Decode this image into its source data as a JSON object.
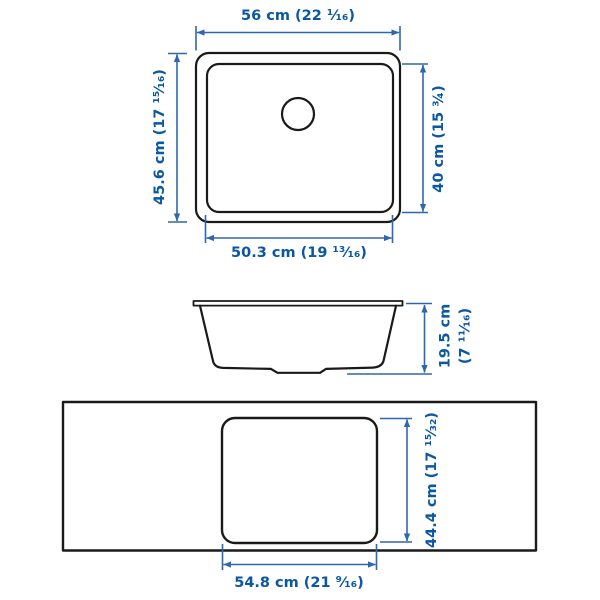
{
  "diagram": {
    "subject": "sink-dimension-drawing",
    "colors": {
      "dimension_blue": "#0a57a4",
      "dimension_line_blue": "#2e67ad",
      "drawing_black": "#1a1a1a",
      "background": "#ffffff"
    },
    "top_view": {
      "width_label": "56 cm (22 ¹⁄₁₆)",
      "height_label": "45.6 cm (17 ¹⁵⁄₁₆)",
      "inner_height_label": "40 cm (15 ¾)",
      "inner_width_label": "50.3 cm (19 ¹³⁄₁₆)"
    },
    "side_view": {
      "height_label_line1": "19.5 cm",
      "height_label_line2": "(7 ¹¹⁄₁₆)"
    },
    "cutout_view": {
      "height_label": "44.4 cm (17 ¹⁵⁄₃₂)",
      "width_label": "54.8 cm (21 ⁹⁄₁₆)"
    }
  }
}
